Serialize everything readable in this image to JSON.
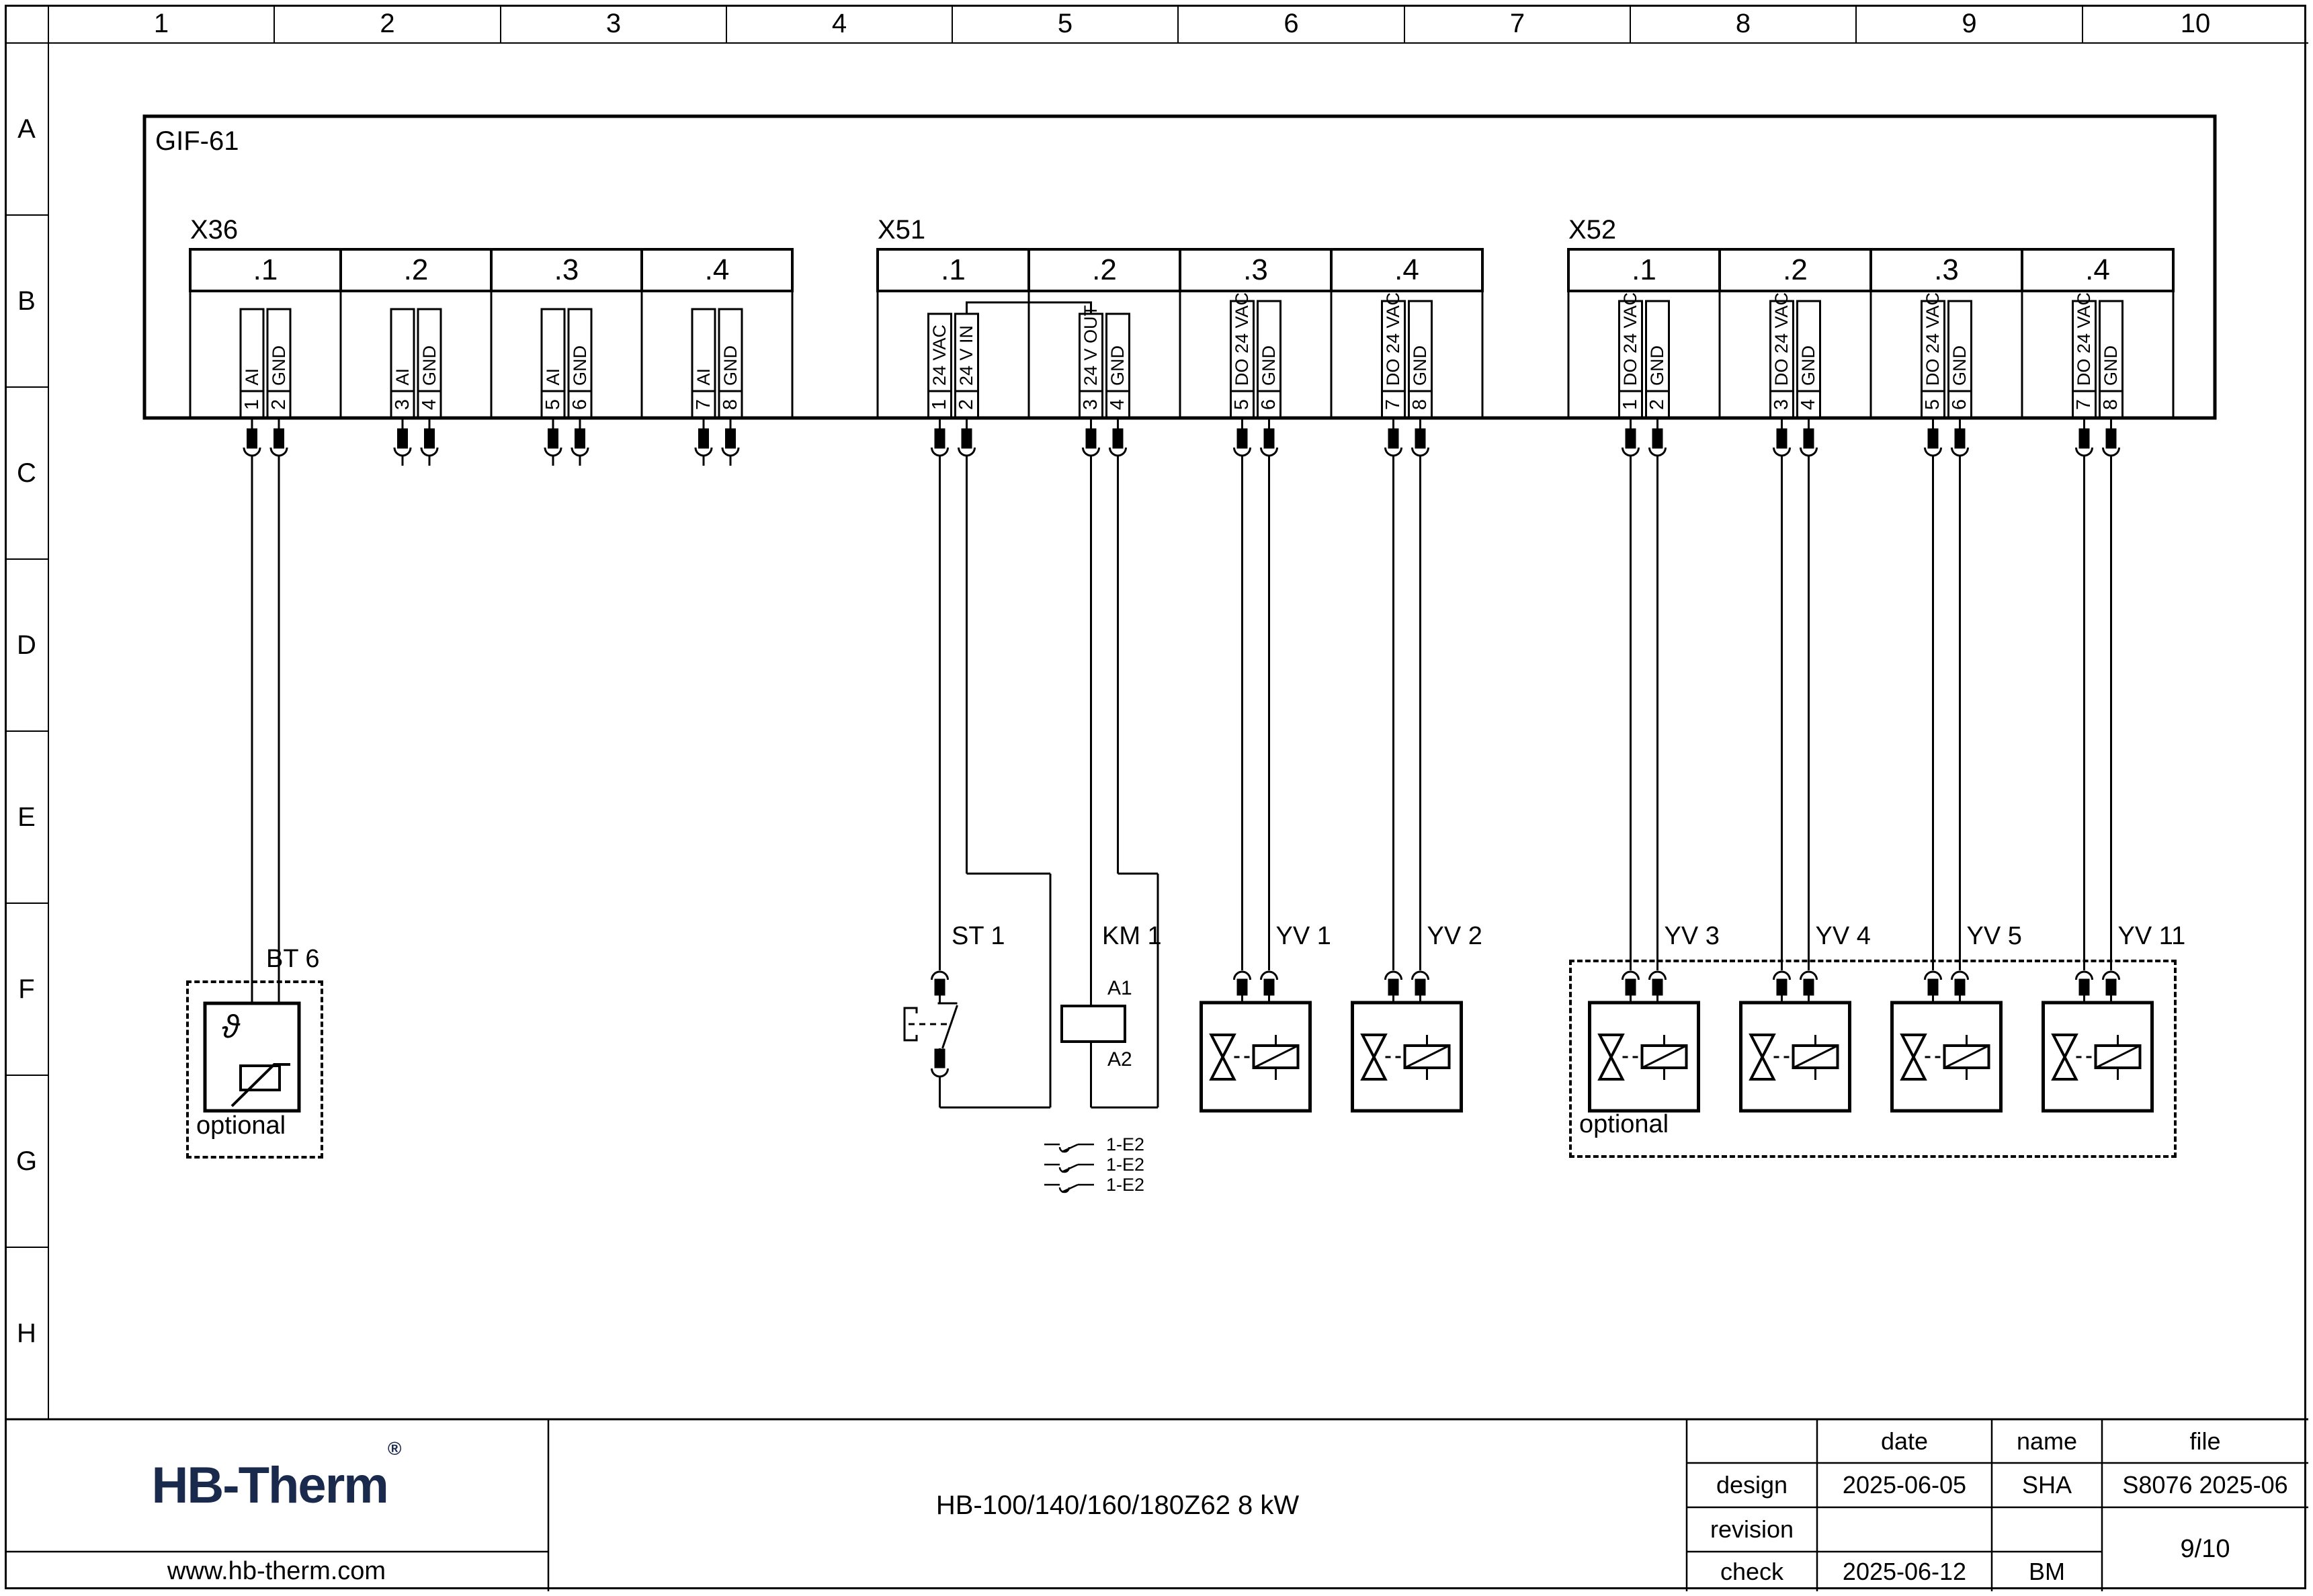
{
  "grid": {
    "columns": [
      "1",
      "2",
      "3",
      "4",
      "5",
      "6",
      "7",
      "8",
      "9",
      "10"
    ],
    "rows": [
      "A",
      "B",
      "C",
      "D",
      "E",
      "F",
      "G",
      "H"
    ]
  },
  "unit": {
    "label": "GIF-61"
  },
  "connectors": [
    {
      "id": "X36",
      "label": "X36",
      "groups": [
        {
          "label": ".1",
          "pins": [
            {
              "no": "1",
              "signal": "AI"
            },
            {
              "no": "2",
              "signal": "GND"
            }
          ]
        },
        {
          "label": ".2",
          "pins": [
            {
              "no": "3",
              "signal": "AI"
            },
            {
              "no": "4",
              "signal": "GND"
            }
          ]
        },
        {
          "label": ".3",
          "pins": [
            {
              "no": "5",
              "signal": "AI"
            },
            {
              "no": "6",
              "signal": "GND"
            }
          ]
        },
        {
          "label": ".4",
          "pins": [
            {
              "no": "7",
              "signal": "AI"
            },
            {
              "no": "8",
              "signal": "GND"
            }
          ]
        }
      ]
    },
    {
      "id": "X51",
      "label": "X51",
      "groups": [
        {
          "label": ".1",
          "pins": [
            {
              "no": "1",
              "signal": "24 VAC"
            },
            {
              "no": "2",
              "signal": "24 V IN"
            }
          ]
        },
        {
          "label": ".2",
          "pins": [
            {
              "no": "3",
              "signal": "24 V OUT"
            },
            {
              "no": "4",
              "signal": "GND"
            }
          ]
        },
        {
          "label": ".3",
          "pins": [
            {
              "no": "5",
              "signal": "DO 24 VAC"
            },
            {
              "no": "6",
              "signal": "GND"
            }
          ]
        },
        {
          "label": ".4",
          "pins": [
            {
              "no": "7",
              "signal": "DO 24 VAC"
            },
            {
              "no": "8",
              "signal": "GND"
            }
          ]
        }
      ]
    },
    {
      "id": "X52",
      "label": "X52",
      "groups": [
        {
          "label": ".1",
          "pins": [
            {
              "no": "1",
              "signal": "DO 24 VAC"
            },
            {
              "no": "2",
              "signal": "GND"
            }
          ]
        },
        {
          "label": ".2",
          "pins": [
            {
              "no": "3",
              "signal": "DO 24 VAC"
            },
            {
              "no": "4",
              "signal": "GND"
            }
          ]
        },
        {
          "label": ".3",
          "pins": [
            {
              "no": "5",
              "signal": "DO 24 VAC"
            },
            {
              "no": "6",
              "signal": "GND"
            }
          ]
        },
        {
          "label": ".4",
          "pins": [
            {
              "no": "7",
              "signal": "DO 24 VAC"
            },
            {
              "no": "8",
              "signal": "GND"
            }
          ]
        }
      ]
    }
  ],
  "devices": {
    "bt6": {
      "label": "BT 6",
      "symbol": "ϑ",
      "note": "optional"
    },
    "st1": {
      "label": "ST 1"
    },
    "km1": {
      "label": "KM 1",
      "a1": "A1",
      "a2": "A2"
    },
    "valves": [
      {
        "label": "YV 1"
      },
      {
        "label": "YV 2"
      }
    ],
    "optional_valves": {
      "note": "optional",
      "items": [
        {
          "label": "YV 3"
        },
        {
          "label": "YV 4"
        },
        {
          "label": "YV 5"
        },
        {
          "label": "YV 11"
        }
      ]
    }
  },
  "contacts": [
    {
      "label": "1-E2"
    },
    {
      "label": "1-E2"
    },
    {
      "label": "1-E2"
    }
  ],
  "titleblock": {
    "company": "HB-Therm",
    "registered": "®",
    "website": "www.hb-therm.com",
    "title": "HB-100/140/160/180Z62 8 kW",
    "table": {
      "col_headers": [
        "date",
        "name",
        "file"
      ],
      "rows": [
        {
          "label": "design",
          "date": "2025-06-05",
          "name": "SHA",
          "file": "S8076 2025-06"
        },
        {
          "label": "revision",
          "date": "",
          "name": "",
          "file": ""
        },
        {
          "label": "check",
          "date": "2025-06-12",
          "name": "BM",
          "file": ""
        }
      ],
      "page": "9/10"
    }
  },
  "colors": {
    "line": "#000000",
    "logo": "#1a2a4d"
  }
}
